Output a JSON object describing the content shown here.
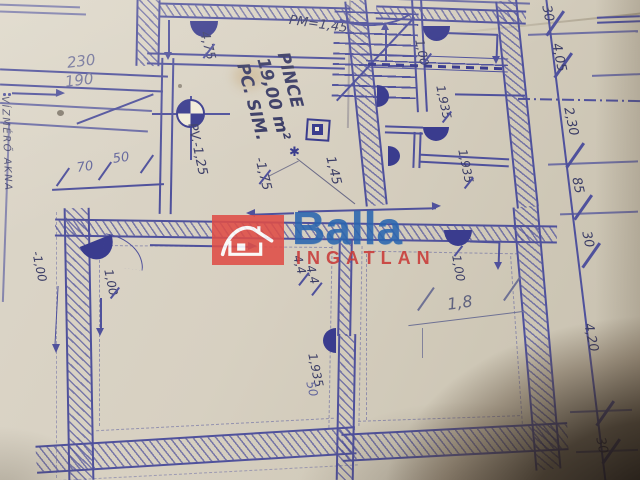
{
  "watermark": {
    "brand": "Balla",
    "subtitle": "INGATLAN",
    "house_icon": "house-icon",
    "brand_color": "#2a66b0",
    "subtitle_color": "#c93a38",
    "box_color": "#df4e47"
  },
  "room": {
    "name": "PINCE",
    "area": "19,00 m²",
    "note": "PC. SIM."
  },
  "levels": {
    "pm": "PM=1,45",
    "pv": "PV.-1,25",
    "neg175": "-1,75",
    "pos475": "4,75",
    "neg100": "-1,00"
  },
  "dims": {
    "top_left_upper": "230",
    "top_left_lower": "190",
    "w70": "70",
    "w50": "50",
    "w50b": "50",
    "d145": "1,45",
    "d100_tr": "1,00",
    "d100_bl": "1,00",
    "d100_br": "1,00",
    "d1935_a": "1,935",
    "d1935_b": "1,935",
    "d1935_c": "1,935",
    "d44_a": "4,4",
    "d44_b": "4,4",
    "d18": "1,8",
    "chain": [
      "30",
      "4,05",
      "2,30",
      "85",
      "30",
      "4,20",
      "30"
    ]
  },
  "notes": {
    "left_margin": "VÍZMÉRŐ AKNA",
    "star_mark": "✱"
  },
  "colors": {
    "ink": "#4f519c",
    "ink_dark": "#3a3c8e",
    "pencil": "#6e7194",
    "paper": "#d5cec0",
    "shadow": "#2a2017"
  }
}
